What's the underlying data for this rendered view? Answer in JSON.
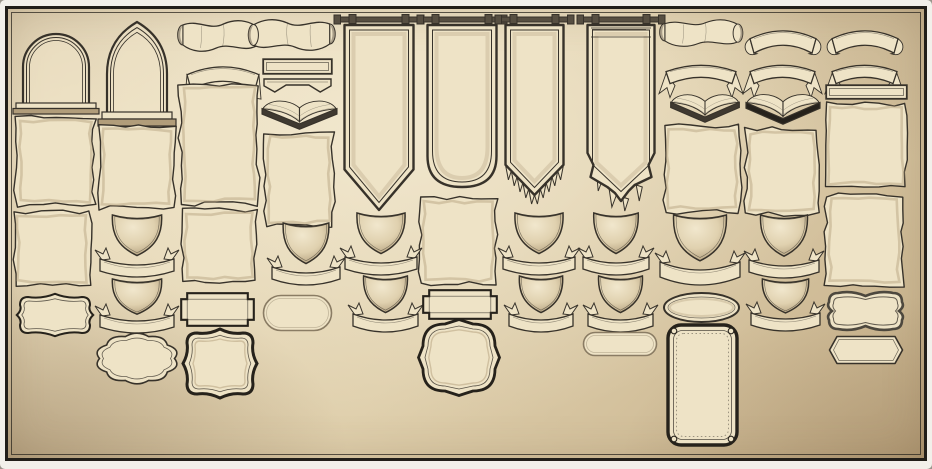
{
  "canvas": {
    "width": 932,
    "height": 469
  },
  "palette": {
    "ink": "#37322a",
    "ink_dark": "#26221b",
    "paper": "#eee3c6",
    "shade": "#b19d7a",
    "shadow": "#6e6353",
    "rod": "#574f42",
    "bg_light": "#ecdfc0",
    "bg_mid": "#dfcfac",
    "bg_dark": "#c4ae88",
    "margin": "#f2f0ea",
    "frame": "#211e19",
    "pill_line": "#8a7c64"
  },
  "elements": [
    {
      "name": "arch-window-round",
      "type": "arch",
      "v": "round",
      "x": 16,
      "y": 20,
      "w": 80,
      "h": 94
    },
    {
      "name": "arch-window-gothic",
      "type": "arch",
      "v": "gothic",
      "x": 100,
      "y": 18,
      "w": 74,
      "h": 108
    },
    {
      "name": "scroll-banner-1",
      "type": "scroll",
      "x": 175,
      "y": 15,
      "w": 88,
      "h": 44
    },
    {
      "name": "scroll-banner-2",
      "type": "scroll",
      "v": "flip",
      "x": 246,
      "y": 14,
      "w": 92,
      "h": 44
    },
    {
      "name": "ribbon-arch-plain",
      "type": "ribbonArch",
      "v": "simple",
      "x": 181,
      "y": 56,
      "w": 84,
      "h": 36
    },
    {
      "name": "parchment-col3a",
      "type": "parchment",
      "x": 178,
      "y": 82,
      "w": 82,
      "h": 124,
      "seed": 3
    },
    {
      "name": "strip-banner-plain-1",
      "type": "strip",
      "x": 262,
      "y": 58,
      "w": 71,
      "h": 17
    },
    {
      "name": "strip-banner-swallowtail",
      "type": "strip",
      "v": "tail",
      "x": 262,
      "y": 77,
      "w": 71,
      "h": 16
    },
    {
      "name": "open-book-1",
      "type": "book",
      "x": 257,
      "y": 90,
      "w": 85,
      "h": 40
    },
    {
      "name": "parchment-col4",
      "type": "parchment",
      "x": 263,
      "y": 131,
      "w": 72,
      "h": 97,
      "seed": 4
    },
    {
      "name": "hanging-banner-pointed",
      "type": "banner",
      "v": "pointed",
      "x": 340,
      "y": 14,
      "w": 78,
      "h": 201
    },
    {
      "name": "hanging-banner-rounded",
      "type": "banner",
      "v": "rounded",
      "x": 423,
      "y": 14,
      "w": 78,
      "h": 178
    },
    {
      "name": "hanging-banner-fringed",
      "type": "banner",
      "v": "fringed",
      "x": 501,
      "y": 14,
      "w": 67,
      "h": 199
    },
    {
      "name": "hanging-banner-ragged",
      "type": "banner",
      "v": "ragged",
      "x": 583,
      "y": 14,
      "w": 76,
      "h": 199
    },
    {
      "name": "scroll-banner-3",
      "type": "scroll",
      "x": 657,
      "y": 15,
      "w": 88,
      "h": 38
    },
    {
      "name": "ribbon-arch-curled-1",
      "type": "ribbonArch",
      "v": "curl",
      "x": 744,
      "y": 20,
      "w": 78,
      "h": 36
    },
    {
      "name": "ribbon-arch-curled-2",
      "type": "ribbonArch",
      "v": "curl",
      "x": 826,
      "y": 20,
      "w": 78,
      "h": 36
    },
    {
      "name": "ribbon-arch-forked-1",
      "type": "ribbonArch",
      "v": "fork",
      "x": 660,
      "y": 56,
      "w": 82,
      "h": 30
    },
    {
      "name": "ribbon-arch-forked-2",
      "type": "ribbonArch",
      "v": "fork",
      "x": 744,
      "y": 56,
      "w": 77,
      "h": 30
    },
    {
      "name": "ribbon-arch-forked-3",
      "type": "ribbonArch",
      "v": "fork",
      "x": 826,
      "y": 56,
      "w": 77,
      "h": 30
    },
    {
      "name": "open-book-2",
      "type": "book",
      "x": 666,
      "y": 84,
      "w": 78,
      "h": 39
    },
    {
      "name": "open-book-3",
      "type": "book",
      "v": "dark",
      "x": 741,
      "y": 83,
      "w": 84,
      "h": 42
    },
    {
      "name": "strip-banner-plain-2",
      "type": "strip",
      "x": 825,
      "y": 84,
      "w": 83,
      "h": 16
    },
    {
      "name": "parchment-col1a",
      "type": "parchment",
      "x": 14,
      "y": 115,
      "w": 82,
      "h": 92,
      "seed": 11
    },
    {
      "name": "parchment-col2",
      "type": "parchment",
      "x": 97,
      "y": 124,
      "w": 79,
      "h": 86,
      "seed": 12
    },
    {
      "name": "parchment-col9",
      "type": "parchment",
      "x": 662,
      "y": 124,
      "w": 80,
      "h": 90,
      "seed": 13
    },
    {
      "name": "parchment-col10",
      "type": "parchment",
      "x": 744,
      "y": 127,
      "w": 76,
      "h": 89,
      "seed": 14
    },
    {
      "name": "parchment-col11a",
      "type": "parchment",
      "x": 823,
      "y": 102,
      "w": 85,
      "h": 87,
      "seed": 15
    },
    {
      "name": "parchment-col1b",
      "type": "parchment",
      "x": 12,
      "y": 210,
      "w": 80,
      "h": 77,
      "seed": 16
    },
    {
      "name": "parchment-col3b",
      "type": "parchment",
      "x": 180,
      "y": 208,
      "w": 78,
      "h": 76,
      "seed": 17
    },
    {
      "name": "parchment-col6",
      "type": "parchment",
      "x": 418,
      "y": 196,
      "w": 80,
      "h": 90,
      "seed": 18
    },
    {
      "name": "parchment-col11b",
      "type": "parchment",
      "x": 824,
      "y": 193,
      "w": 80,
      "h": 95,
      "seed": 19
    },
    {
      "name": "shield-banderole-1",
      "type": "shieldRibbon",
      "x": 96,
      "y": 208,
      "w": 82,
      "h": 72
    },
    {
      "name": "shield-banderole-2",
      "type": "shieldRibbon",
      "x": 96,
      "y": 272,
      "w": 82,
      "h": 64
    },
    {
      "name": "shield-banderole-3",
      "type": "shieldRibbon",
      "x": 268,
      "y": 216,
      "w": 76,
      "h": 72
    },
    {
      "name": "shield-banderole-4",
      "type": "shieldRibbon",
      "x": 341,
      "y": 206,
      "w": 80,
      "h": 72
    },
    {
      "name": "shield-banderole-5",
      "type": "shieldRibbon",
      "x": 349,
      "y": 269,
      "w": 73,
      "h": 66
    },
    {
      "name": "shield-banderole-6",
      "type": "shieldRibbon",
      "x": 499,
      "y": 206,
      "w": 80,
      "h": 72
    },
    {
      "name": "shield-banderole-7",
      "type": "shieldRibbon",
      "x": 505,
      "y": 269,
      "w": 72,
      "h": 66
    },
    {
      "name": "shield-banderole-8",
      "type": "shieldRibbon",
      "x": 579,
      "y": 206,
      "w": 74,
      "h": 72
    },
    {
      "name": "shield-banderole-9",
      "type": "shieldRibbon",
      "x": 584,
      "y": 269,
      "w": 73,
      "h": 66
    },
    {
      "name": "shield-banderole-10",
      "type": "shieldRibbon",
      "v": "wide",
      "x": 656,
      "y": 208,
      "w": 88,
      "h": 80
    },
    {
      "name": "shield-banderole-11",
      "type": "shieldRibbon",
      "x": 745,
      "y": 208,
      "w": 78,
      "h": 73
    },
    {
      "name": "shield-banderole-12",
      "type": "shieldRibbon",
      "x": 747,
      "y": 272,
      "w": 77,
      "h": 62
    },
    {
      "name": "plaque-bracket",
      "type": "bracket",
      "x": 17,
      "y": 294,
      "w": 76,
      "h": 42
    },
    {
      "name": "plaque-notched-1",
      "type": "notched",
      "x": 179,
      "y": 291,
      "w": 77,
      "h": 37
    },
    {
      "name": "plaque-pill-1",
      "type": "pill",
      "x": 262,
      "y": 294,
      "w": 71,
      "h": 38
    },
    {
      "name": "plaque-notched-2",
      "type": "notched",
      "x": 421,
      "y": 288,
      "w": 78,
      "h": 33
    },
    {
      "name": "plaque-ellipse",
      "type": "ellipse",
      "x": 662,
      "y": 291,
      "w": 79,
      "h": 33
    },
    {
      "name": "plaque-wavy-rect",
      "type": "wavyRect",
      "x": 826,
      "y": 290,
      "w": 79,
      "h": 42
    },
    {
      "name": "plaque-scalloped-oval",
      "type": "scallop",
      "x": 97,
      "y": 333,
      "w": 80,
      "h": 51
    },
    {
      "name": "plaque-ornate-square",
      "type": "ornate",
      "v": "square",
      "x": 183,
      "y": 329,
      "w": 74,
      "h": 69
    },
    {
      "name": "plaque-ornate-round",
      "type": "ornate",
      "v": "round",
      "x": 419,
      "y": 320,
      "w": 80,
      "h": 75
    },
    {
      "name": "plaque-pill-2",
      "type": "pill",
      "x": 582,
      "y": 331,
      "w": 76,
      "h": 26
    },
    {
      "name": "plaque-card-tall",
      "type": "card",
      "x": 666,
      "y": 323,
      "w": 73,
      "h": 124
    },
    {
      "name": "plaque-hexagon",
      "type": "hex",
      "x": 827,
      "y": 334,
      "w": 78,
      "h": 32
    }
  ]
}
